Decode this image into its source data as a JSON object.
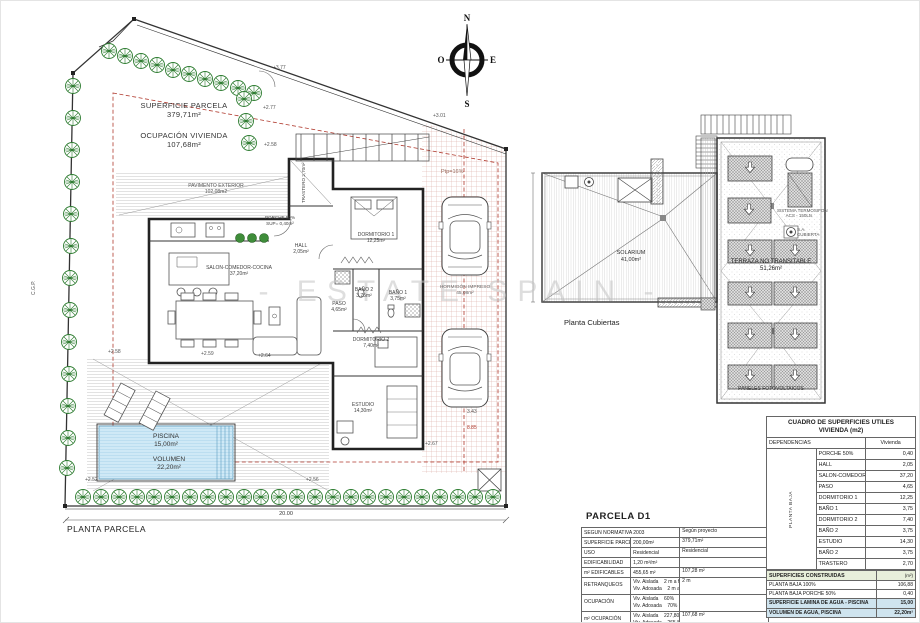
{
  "colors": {
    "accent_red": "#b03a2e",
    "total_row": "#f6ddc6",
    "water_row": "#cfe4ef",
    "header_green": "#e8efdb",
    "pool_blue": "#cfe9f6",
    "tree_green": "#2f7d32"
  },
  "compass": {
    "n": "N",
    "s": "S",
    "e": "E",
    "o": "O"
  },
  "watermark": "- ESTATE SPAIN -",
  "site": {
    "plan_label": "PLANTA PARCELA",
    "superficie_l1": "SUPERFICIE PARCELA",
    "superficie_l2": "379,71m²",
    "ocupacion_l1": "OCUPACIÓN VIVIENDA",
    "ocupacion_l2": "107,68m²",
    "pavimento_l1": "PAVIMENTO EXTERIOR",
    "pavimento_l2": "102,08m2",
    "piscina_l1": "PISCINA",
    "piscina_l2": "15,00m²",
    "volumen_l1": "VOLUMEN",
    "volumen_l2": "22,20m²",
    "hormigon_l1": "HORMIGÓN IMPRESO",
    "hormigon_l2": "45,08m²",
    "ptp": "Ptp=16%",
    "cgp": "C.G.P.",
    "dim_total": "20.00",
    "dims": [
      "+3.77",
      "+2.77",
      "+2.58",
      "+2.58",
      "+2.59",
      "+2.64",
      "+2.52",
      "+2.56",
      "+2.67",
      "+3.01",
      "3.43",
      "8.85"
    ]
  },
  "rooms": {
    "salon_l1": "SALON-COMEDOR-COCINA",
    "salon_l2": "37,20m²",
    "dorm1_l1": "DORMITORIO 1",
    "dorm1_l2": "12,25m²",
    "bano1_l1": "BAÑO 1",
    "bano1_l2": "3,75m²",
    "bano2_l1": "BAÑO 2",
    "bano2_l2": "3,75m²",
    "dorm2_l1": "DORMITORIO 2",
    "dorm2_l2": "7,40m²",
    "estudio_l1": "ESTUDIO",
    "estudio_l2": "14,30m²",
    "paso_l1": "PASO",
    "paso_l2": "4,65m²",
    "hall_l1": "HALL",
    "hall_l2": "2,05m²",
    "porche_l1": "PORCHE 50%",
    "porche_l2": "SUP= 0,40m²",
    "trastero": "TRASTERO 2,70m²"
  },
  "roof": {
    "label": "Planta Cubiertas",
    "solarium_l1": "SOLARIUM",
    "solarium_l2": "41,00m²"
  },
  "pv": {
    "terraza_l1": "TERRAZA NO TRANSITABLE",
    "terraza_l2": "51,26m²",
    "paneles": "PANELES FOTOVOLTAICOS",
    "acs_l1": "SISTEMA TERMOSIFON",
    "acs_l2": "ACS - 150Lts",
    "sa_l1": "S.A.",
    "sa_l2": "CUBIERTA"
  },
  "parcela": {
    "title": "PARCELA D1",
    "norm_header": "SEGUN NORMATIVA 2003",
    "proj_header": "Según proyecto",
    "rows": [
      {
        "label": "SUPERFICIE PARCELA",
        "norm": "200,00m²",
        "project": "379,71m²"
      },
      {
        "label": "USO",
        "norm": "Residencial",
        "project": "Residencial"
      },
      {
        "label": "EDIFICABILIDAD",
        "norm": "1,20 m²/m²",
        "project": ""
      },
      {
        "label": "m² EDIFICABLES",
        "norm": "455,65 m²",
        "project": "107,28 m²"
      },
      {
        "label": "RETRANQUEOS",
        "norm": "Viv. Aislada    2 m a fachada y lindes",
        "norm2": "Viv. Adosada    2 m a fachada",
        "project": "2 m"
      },
      {
        "label": "OCUPACIÓN",
        "norm": "Viv. Aislada    60%",
        "norm2": "Viv. Adosada    70%",
        "project": ""
      },
      {
        "label": "m² OCUPACIÓN",
        "norm": "Viv. Aislada    227,80m²",
        "norm2": "Viv. Adosada    265,80m²",
        "project": "107,68 m²"
      }
    ]
  },
  "utiles": {
    "title1": "CUADRO DE SUPERFICIES UTILES",
    "title2": "VIVIENDA (m2)",
    "dependencias": "DEPENDENCIAS",
    "vivienda": "Vivienda",
    "group": "PLANTA BAJA",
    "rows": [
      {
        "label": "PORCHE 50%",
        "value": "0,40"
      },
      {
        "label": "HALL",
        "value": "2,05"
      },
      {
        "label": "SALON-COMEDOR-COCINA",
        "value": "37,20"
      },
      {
        "label": "PASO",
        "value": "4,65"
      },
      {
        "label": "DORMITORIO 1",
        "value": "12,25"
      },
      {
        "label": "BAÑO 1",
        "value": "3,75"
      },
      {
        "label": "DORMITORIO 2",
        "value": "7,40"
      },
      {
        "label": "BAÑO 2",
        "value": "3,75"
      },
      {
        "label": "ESTUDIO",
        "value": "14,30"
      },
      {
        "label": "BAÑO 2",
        "value": "3,75"
      },
      {
        "label": "TRASTERO",
        "value": "2,70"
      }
    ],
    "total_label": "TOTAL SUP. UTIL VIV.",
    "total_value": "92,20"
  },
  "constr": {
    "header": "SUPERFICIES CONSTRUIDAS",
    "unit": "(m²)",
    "rows": [
      {
        "label": "PLANTA BAJA 100%",
        "value": "106,88"
      },
      {
        "label": "PLANTA BAJA PORCHE 50%",
        "value": "0,40"
      }
    ],
    "total_label": "TOTAL, SUPERFICIE CONSTRUIDA VIVIENDA",
    "total_value": "107,28",
    "agua": [
      {
        "label": "SUPERFICIE LAMINA DE AGUA - PISCINA",
        "value": "15,00"
      },
      {
        "label": "VOLUMEN DE AGUA, PISCINA",
        "value": "22,20m²"
      }
    ]
  }
}
